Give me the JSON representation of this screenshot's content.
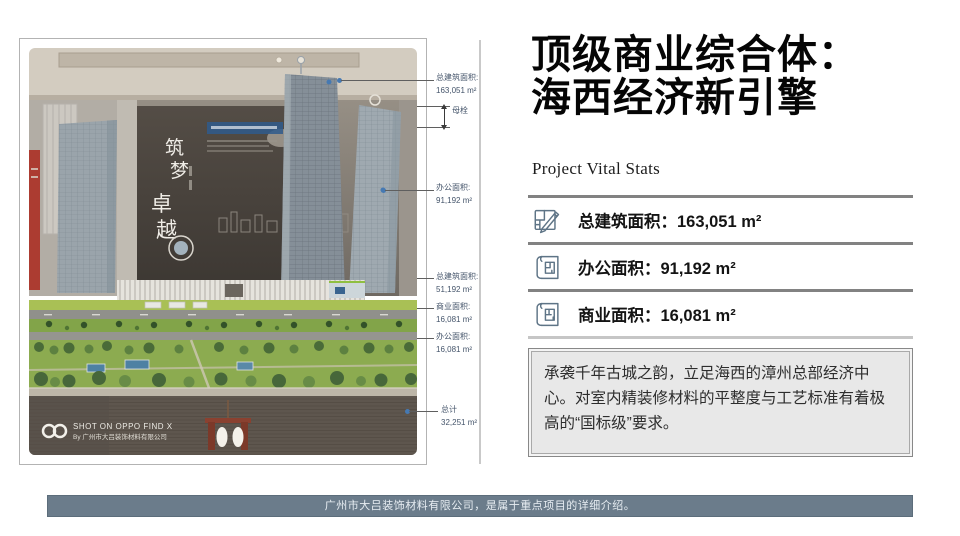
{
  "slide": {
    "title_line1": "顶级商业综合体：",
    "title_line2": "海西经济新引擎",
    "subtitle": "Project Vital Stats",
    "stats": [
      {
        "label": "总建筑面积：",
        "value": "163,051 m²",
        "icon": "blueprint-pencil-icon"
      },
      {
        "label": "办公面积：",
        "value": "91,192 m²",
        "icon": "floorplan-scroll-icon"
      },
      {
        "label": "商业面积：",
        "value": "16,081 m²",
        "icon": "floorplan-scroll-icon"
      }
    ],
    "description": "承袭千年古城之韵，立足海西的漳州总部经济中心。对室内精装修材料的平整度与工艺标准有着极高的“国标级”要求。",
    "footer": "广州市大吕装饰材料有限公司，是属于重点项目的详细介绍。"
  },
  "photo": {
    "annotations": [
      {
        "label": "总建筑面积:",
        "value": "163,051 m²"
      },
      {
        "label": "办公面积:",
        "value": "91,192 m²"
      },
      {
        "label": "总建筑面积:",
        "value": "51,192 m²"
      },
      {
        "label": "商业面积:",
        "value": "16,081 m²"
      },
      {
        "label": "办公面积:",
        "value": "16,081 m²"
      },
      {
        "label": "总计",
        "value": "32,251 m²"
      }
    ],
    "arrow_label": "母栓",
    "calligraphy": [
      "筑",
      "梦",
      "卓",
      "越"
    ],
    "watermark_line1": "SHOT ON OPPO FIND X",
    "watermark_line2": "By 广州市大吕装饰材料有限公司"
  },
  "colors": {
    "footer_bar": "#6b7c8b",
    "annotation_text": "#44546a",
    "stat_icon_stroke": "#5e7486",
    "description_bg": "#e8e8e8",
    "marker_dot": "#4679b2"
  }
}
